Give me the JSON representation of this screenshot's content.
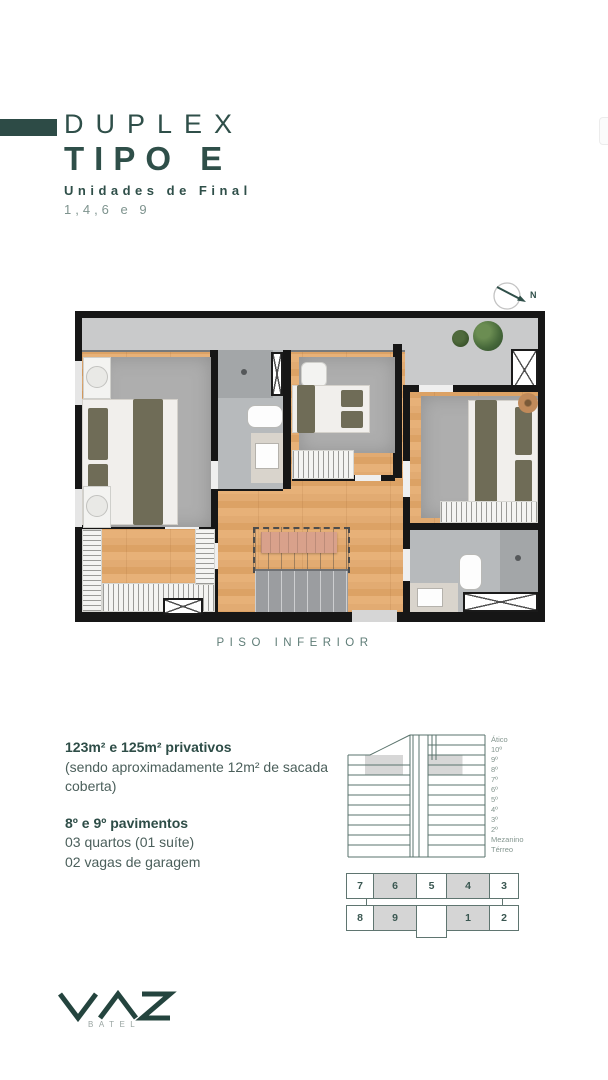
{
  "header": {
    "accent_color": "#2d4b46",
    "title_line1": "DUPLEX",
    "title_line2": "TIPO E",
    "subtitle": "Unidades de Final",
    "units_line": "1,4,6 e 9"
  },
  "compass": {
    "label": "N"
  },
  "plan": {
    "caption": "PISO INFERIOR"
  },
  "details": {
    "area_title": "123m² e 125m² privativos",
    "area_note_1": "(sendo aproximadamente 12m² de sacada",
    "area_note_2": "coberta)",
    "floors_title": "8º e 9º pavimentos",
    "line_bedrooms": "03 quartos (01 suíte)",
    "line_parking": "02 vagas de garagem"
  },
  "section": {
    "floors": [
      "Ático",
      "10º",
      "9º",
      "8º",
      "7º",
      "6º",
      "5º",
      "4º",
      "3º",
      "2º",
      "Mezanino",
      "Térreo"
    ],
    "highlighted_floors": [
      "8º",
      "9º"
    ],
    "highlight_color": "#d7d7d7",
    "line_color": "#5a736c"
  },
  "units_map": {
    "top": [
      "7",
      "6",
      "5",
      "4",
      "3"
    ],
    "bottom": [
      "8",
      "9",
      "",
      "1",
      "2"
    ],
    "highlighted": [
      "6",
      "4",
      "9",
      "1"
    ],
    "highlight_color": "#d5d5d5"
  },
  "logo": {
    "brand": "VAZ",
    "sub": "BATEL"
  }
}
